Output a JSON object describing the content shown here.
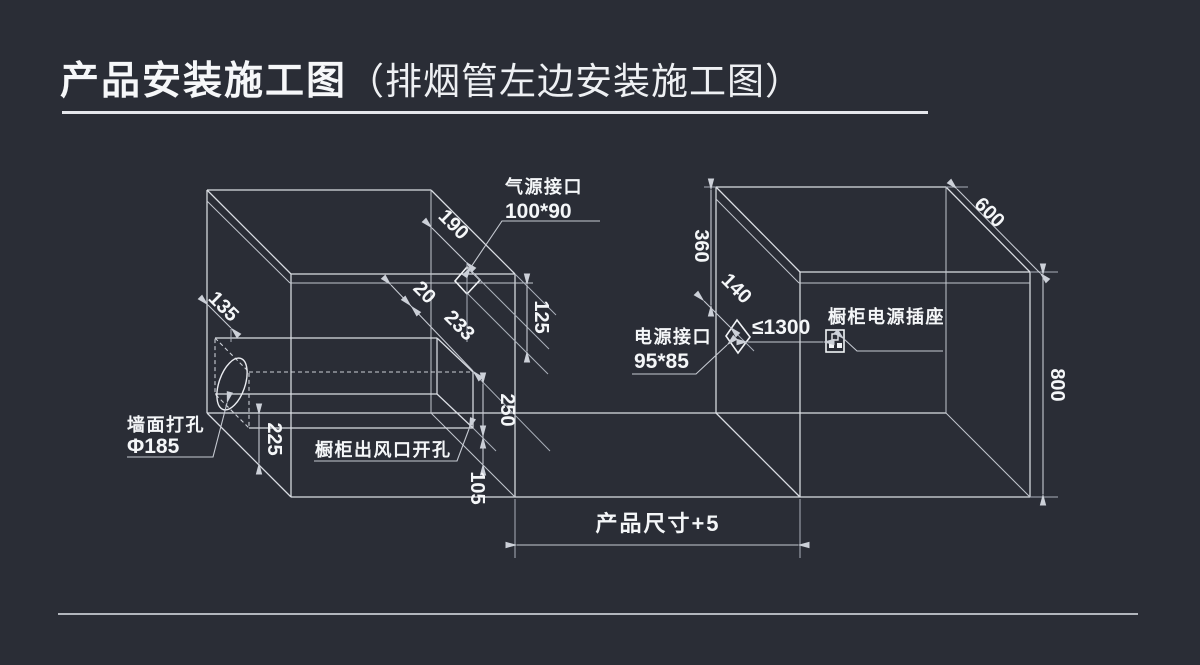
{
  "title": {
    "main": "产品安装施工图",
    "paren": "（排烟管左边安装施工图）"
  },
  "colors": {
    "background": "#2a2d36",
    "line": "#dbdee4",
    "dim_line": "#c6cad2",
    "text": "#f4f6f8"
  },
  "left_cabinet": {
    "dim_135": "135",
    "dim_190": "190",
    "dim_20": "20",
    "dim_233": "233",
    "dim_125": "125",
    "dim_225": "225",
    "dim_250": "250",
    "dim_105": "105",
    "gas_label_line1": "气源接口",
    "gas_label_line2": "100*90",
    "wall_hole_label_line1": "墙面打孔",
    "wall_hole_label_line2": "Φ185",
    "outlet_label": "橱柜出风口开孔"
  },
  "right_cabinet": {
    "dim_360": "360",
    "dim_140": "140",
    "dim_600": "600",
    "dim_800": "800",
    "dim_max_distance": "≤1300",
    "power_label_line1": "电源接口",
    "power_label_line2": "95*85",
    "socket_label": "橱柜电源插座"
  },
  "footer_dim": {
    "product_size": "产品尺寸+5"
  }
}
